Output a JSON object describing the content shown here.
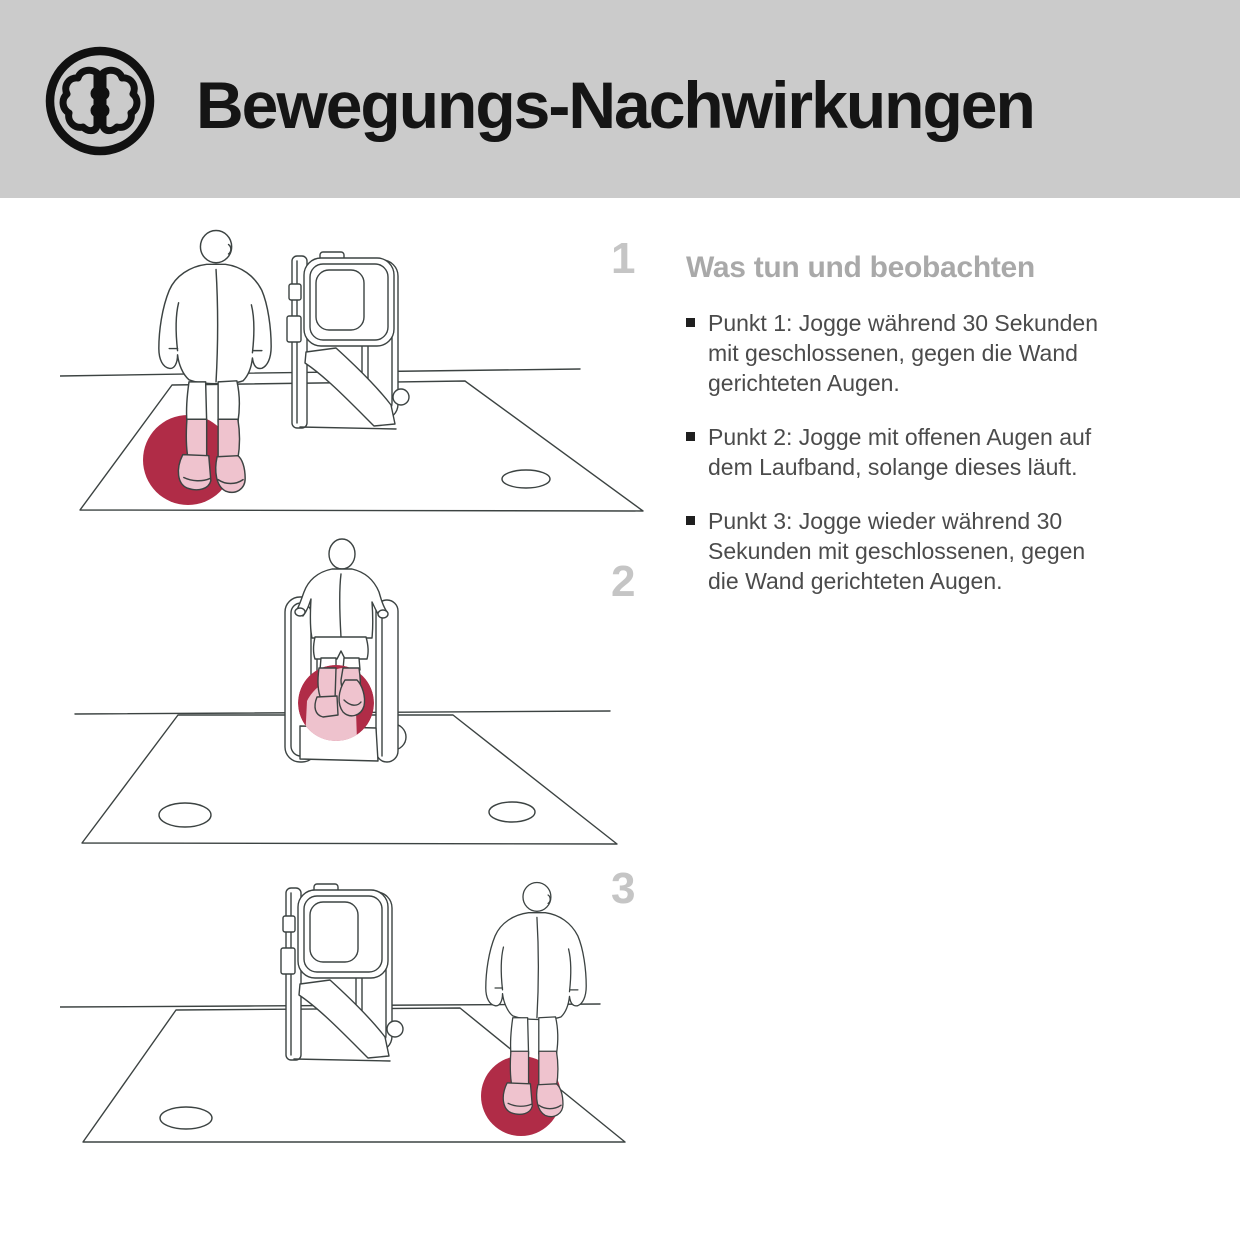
{
  "header": {
    "title": "Bewegungs-Nachwirkungen",
    "icon": "brain-icon"
  },
  "panels": [
    {
      "number": "1"
    },
    {
      "number": "2"
    },
    {
      "number": "3"
    }
  ],
  "instructions": {
    "heading": "Was tun und beobachten",
    "bullets": [
      {
        "lines": [
          "Punkt 1: Jogge während 30 Sekunden",
          "mit geschlossenen, gegen die Wand",
          "gerichteten Augen."
        ]
      },
      {
        "lines": [
          "Punkt 2: Jogge mit offenen Augen auf",
          "dem Laufband, solange dieses läuft.",
          ""
        ]
      },
      {
        "lines": [
          "Punkt 3: Jogge wieder während 30",
          "Sekunden mit geschlossenen, gegen",
          "die Wand gerichteten Augen."
        ]
      }
    ]
  },
  "colors": {
    "header_bg": "#cbcbcb",
    "accent_red": "#b02c47",
    "accent_pink": "#eec2cd",
    "number_gray": "#c5c5c5",
    "heading_gray": "#a9a9a9",
    "line_ink": "#3c4342",
    "text": "#4b4b4b"
  }
}
